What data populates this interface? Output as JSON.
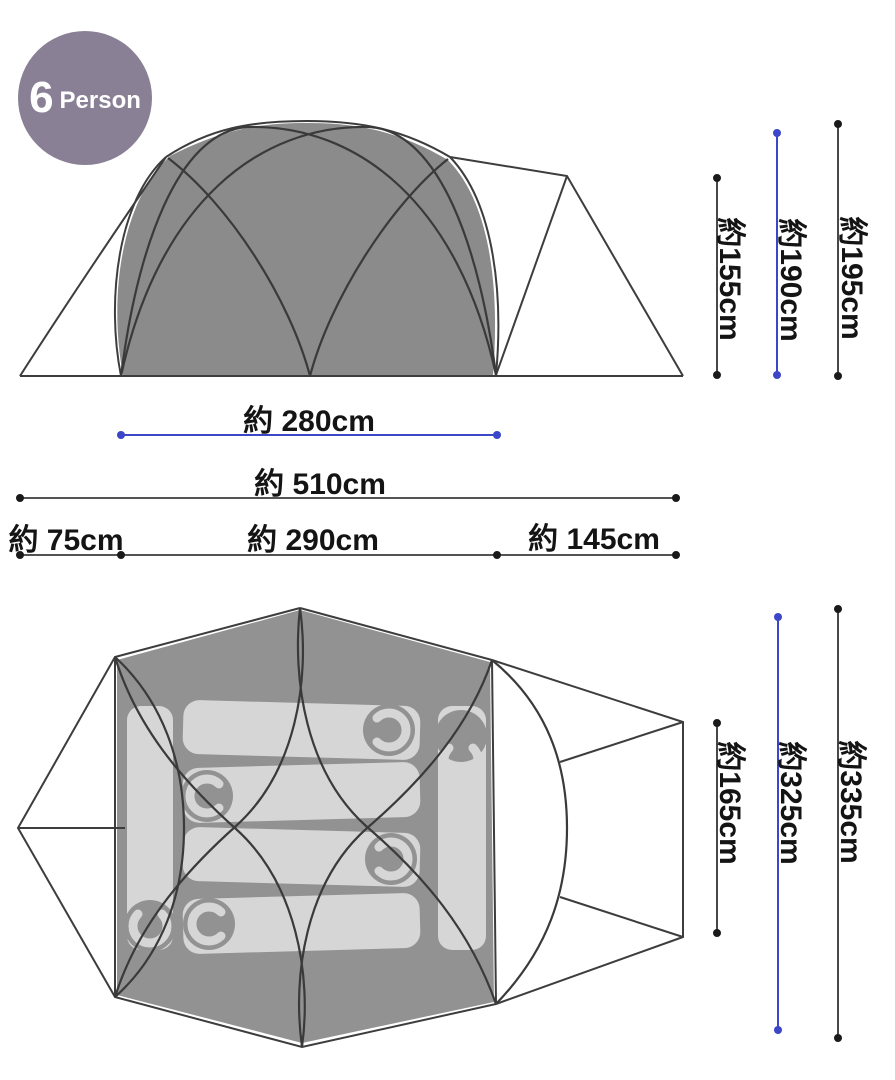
{
  "badge": {
    "number": "6",
    "label": "Person"
  },
  "colors": {
    "badge_purple": "#8a8096",
    "accent_blue": "#3c46c9",
    "dim_line_black": "#1a1a1a",
    "outline_gray": "#3d3d3d",
    "tent_fill_gray": "#8b8b8b",
    "top_inner_fill_gray": "#929292",
    "sleeping_pad_gray": "#d6d6d6",
    "label_text": "#141414"
  },
  "side_view": {
    "description": "tent side elevation with crossing pole arcs and gray inner-tent silhouette",
    "dims": {
      "inner_height": {
        "label": "約155cm",
        "value_cm": 155,
        "color": "black"
      },
      "inner_peak_height": {
        "label": "約190cm",
        "value_cm": 190,
        "color": "blue"
      },
      "total_height": {
        "label": "約195cm",
        "value_cm": 195,
        "color": "black"
      },
      "inner_width": {
        "label": "約 280cm",
        "value_cm": 280,
        "color": "blue"
      },
      "total_length": {
        "label": "約 510cm",
        "value_cm": 510,
        "color": "black"
      },
      "rear_length": {
        "label": "約 75cm",
        "value_cm": 75,
        "color": "black"
      },
      "mid_length": {
        "label": "約 290cm",
        "value_cm": 290,
        "color": "black"
      },
      "front_length": {
        "label": "約 145cm",
        "value_cm": 145,
        "color": "black"
      }
    }
  },
  "top_view": {
    "description": "tent floor plan: hexagonal dome with six sleeping pads and right-side vestibule",
    "dims": {
      "inner_depth": {
        "label": "約165cm",
        "value_cm": 165,
        "color": "black"
      },
      "mid_depth": {
        "label": "約325cm",
        "value_cm": 325,
        "color": "blue"
      },
      "total_depth": {
        "label": "約335cm",
        "value_cm": 335,
        "color": "black"
      }
    }
  }
}
